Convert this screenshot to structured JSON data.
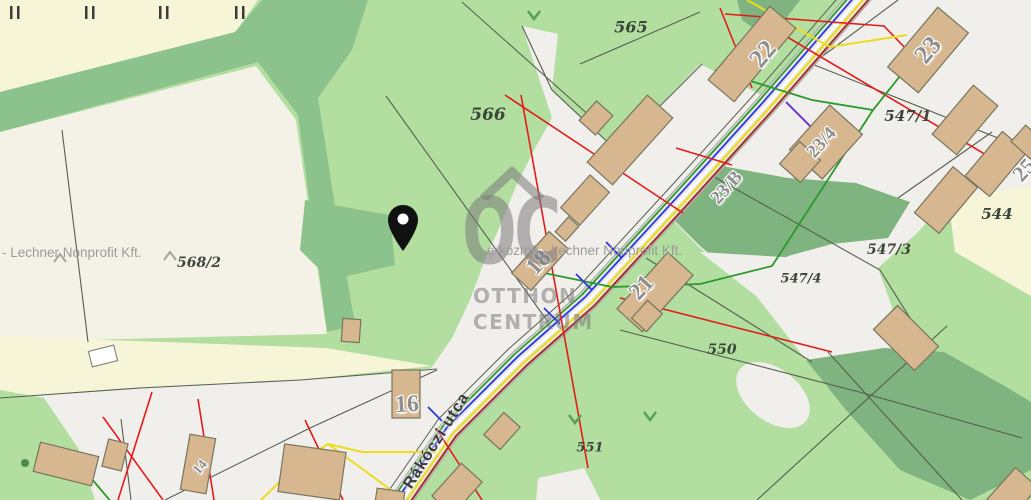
{
  "map": {
    "attribution_left": "- Lechner Nonprofit Kft.",
    "attribution_center": "e-közmű - Lechner Nonprofit Kft.",
    "street_label": "Rákóczi utca",
    "watermark": {
      "logo": "OC",
      "line1": "OTTHON",
      "line2": "CENTRUM"
    },
    "parcel_labels": [
      {
        "text": "565"
      },
      {
        "text": "566"
      },
      {
        "text": "547/1"
      },
      {
        "text": "544"
      },
      {
        "text": "547/3"
      },
      {
        "text": "547/4"
      },
      {
        "text": "550"
      },
      {
        "text": "551"
      },
      {
        "text": "568/2"
      }
    ],
    "building_labels": [
      {
        "text": "22"
      },
      {
        "text": "23"
      },
      {
        "text": "23/4"
      },
      {
        "text": "23/B"
      },
      {
        "text": "25"
      },
      {
        "text": "21"
      },
      {
        "text": "18"
      },
      {
        "text": "16"
      },
      {
        "text": "14"
      }
    ],
    "colors": {
      "light_green": "#b2dea0",
      "band_green": "#8cc28c",
      "forest_green": "#7fb37f",
      "pale_yellow": "#f6f5d7",
      "white_parcel": "#f1efeb",
      "road_fill": "#e9e8e4",
      "building_fill": "#d7b78f",
      "line_red": "#e41c1c",
      "line_green": "#2a9a2a",
      "line_blue": "#2a35e8",
      "line_yellow": "#ecdc20",
      "line_maroon": "#a03026",
      "line_purple": "#6a3bd1",
      "pin_black": "#111111",
      "watermark_gray": "#7a7a7a",
      "house_label_gray": "#8e8e8e",
      "parcel_label_gray": "#3c463a"
    }
  }
}
